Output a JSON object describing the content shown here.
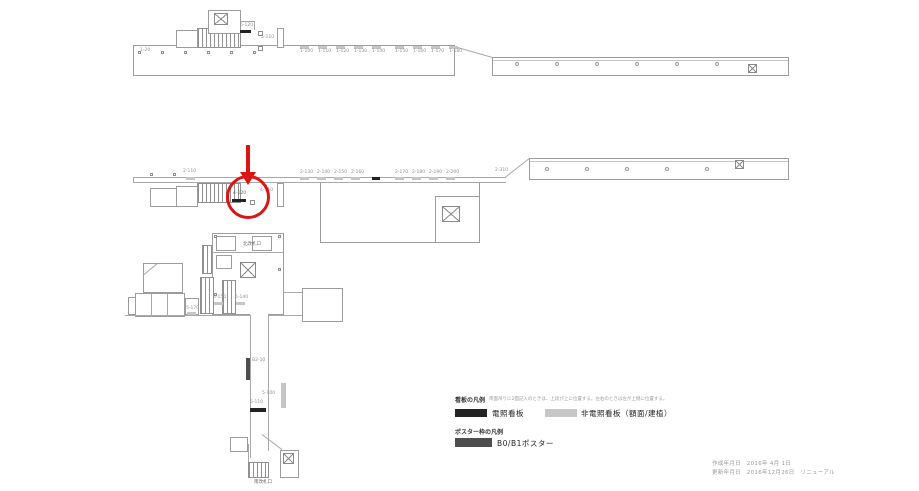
{
  "colors": {
    "highlight_red": "#dd1414",
    "line_gray": "#a8a8a8",
    "sign_lit": "#222222",
    "sign_unlit": "#c6c6c6",
    "poster": "#4d4d4d"
  },
  "upper_plan": {
    "left_sign": "1-20",
    "stair_sign": "5-120",
    "post_sign": "5-110",
    "sign_row": [
      "1-100",
      "1-110",
      "1-120",
      "1-130",
      "1-140",
      "1-150",
      "1-160",
      "1-170",
      "1-180"
    ]
  },
  "middle_plan": {
    "left_sign": "2-110",
    "sign_row": [
      "2-130",
      "2-140",
      "2-150",
      "2-160",
      "2-170",
      "2-180",
      "2-190",
      "2-200"
    ],
    "far_sign": "2-310",
    "circle_sign": "4-120",
    "post_sign": "4-110"
  },
  "lower_plan": {
    "gate_top_label": "北改札口",
    "gate_bottom_label": "南改札口",
    "stair_sign_left": "5-170",
    "stair_sign_a": "5-150",
    "stair_sign_b": "5-140",
    "poster_sign": "B2-10",
    "escalator_sign": "5-100",
    "hall_sign": "5-110"
  },
  "legend": {
    "sign_title": "看板の凡例",
    "sign_note": "両面吊りに2面記入のときは、上段が上に位置する。左右のときは左が上側に位置する。",
    "lit_label": "電照看板",
    "unlit_label": "非電照看板（額面/建植）",
    "poster_title": "ポスター枠の凡例",
    "poster_label": "B0/B1ポスター"
  },
  "footer": {
    "created": "作成年月日　2016年 4月 1日",
    "updated": "更新年月日　2016年12月26日　リニューアル"
  }
}
